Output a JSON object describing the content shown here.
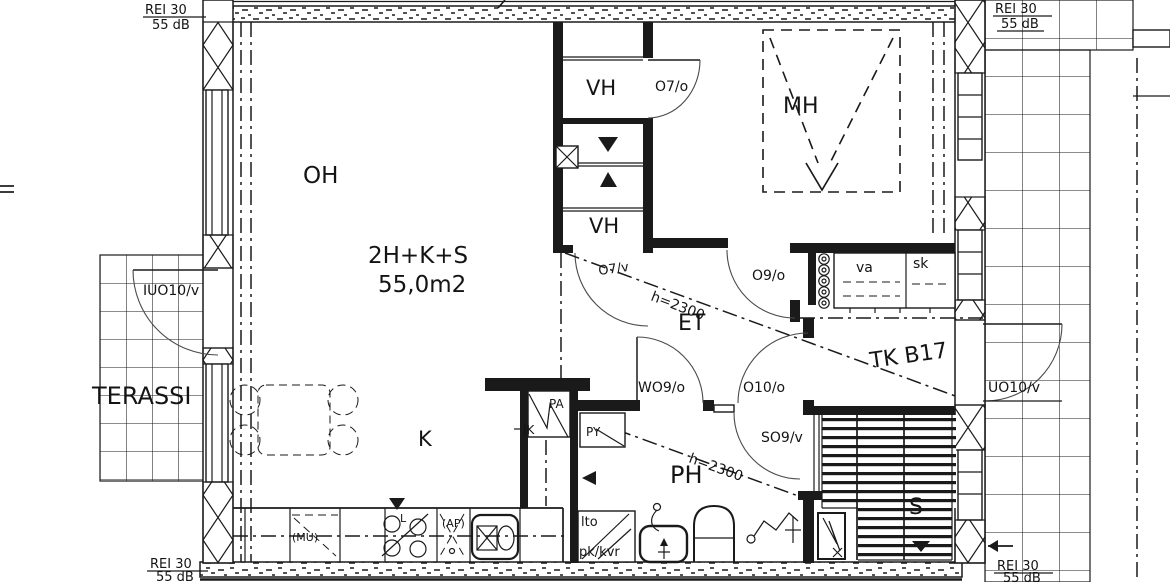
{
  "plan": {
    "unit_type": "2H+K+S",
    "unit_area": "55,0m2",
    "unit_id": "TK B17"
  },
  "rooms": {
    "living": "OH",
    "kitchen": "K",
    "bedroom": "MH",
    "hall": "ET",
    "bathroom": "PH",
    "sauna": "S",
    "closet_upper": "VH",
    "closet_lower": "VH",
    "terrace": "TERASSI"
  },
  "doors": {
    "closet_upper": "O7/o",
    "closet_lower": "O7/v",
    "bedroom": "O9/o",
    "hall": "O10/o",
    "bathroom": "WO9/o",
    "sauna": "SO9/v",
    "terrace": "IUO10/v",
    "balcony": "UO10/v"
  },
  "fixtures": {
    "wardrobe": "va",
    "cleaning_cabinet": "sk",
    "freezer": "PA",
    "fridge": "JK",
    "washing_machine": "PY",
    "heat_recovery": "lto",
    "washer_dryer": "pk/kvr",
    "microwave": "(MU)",
    "dishwasher": "(AP)",
    "stove": "L"
  },
  "annotations": {
    "fire_rating": "REI 30",
    "sound_rating": "55 dB",
    "ceiling_height_hall": "h=2300",
    "ceiling_height_bath": "h=2300"
  }
}
